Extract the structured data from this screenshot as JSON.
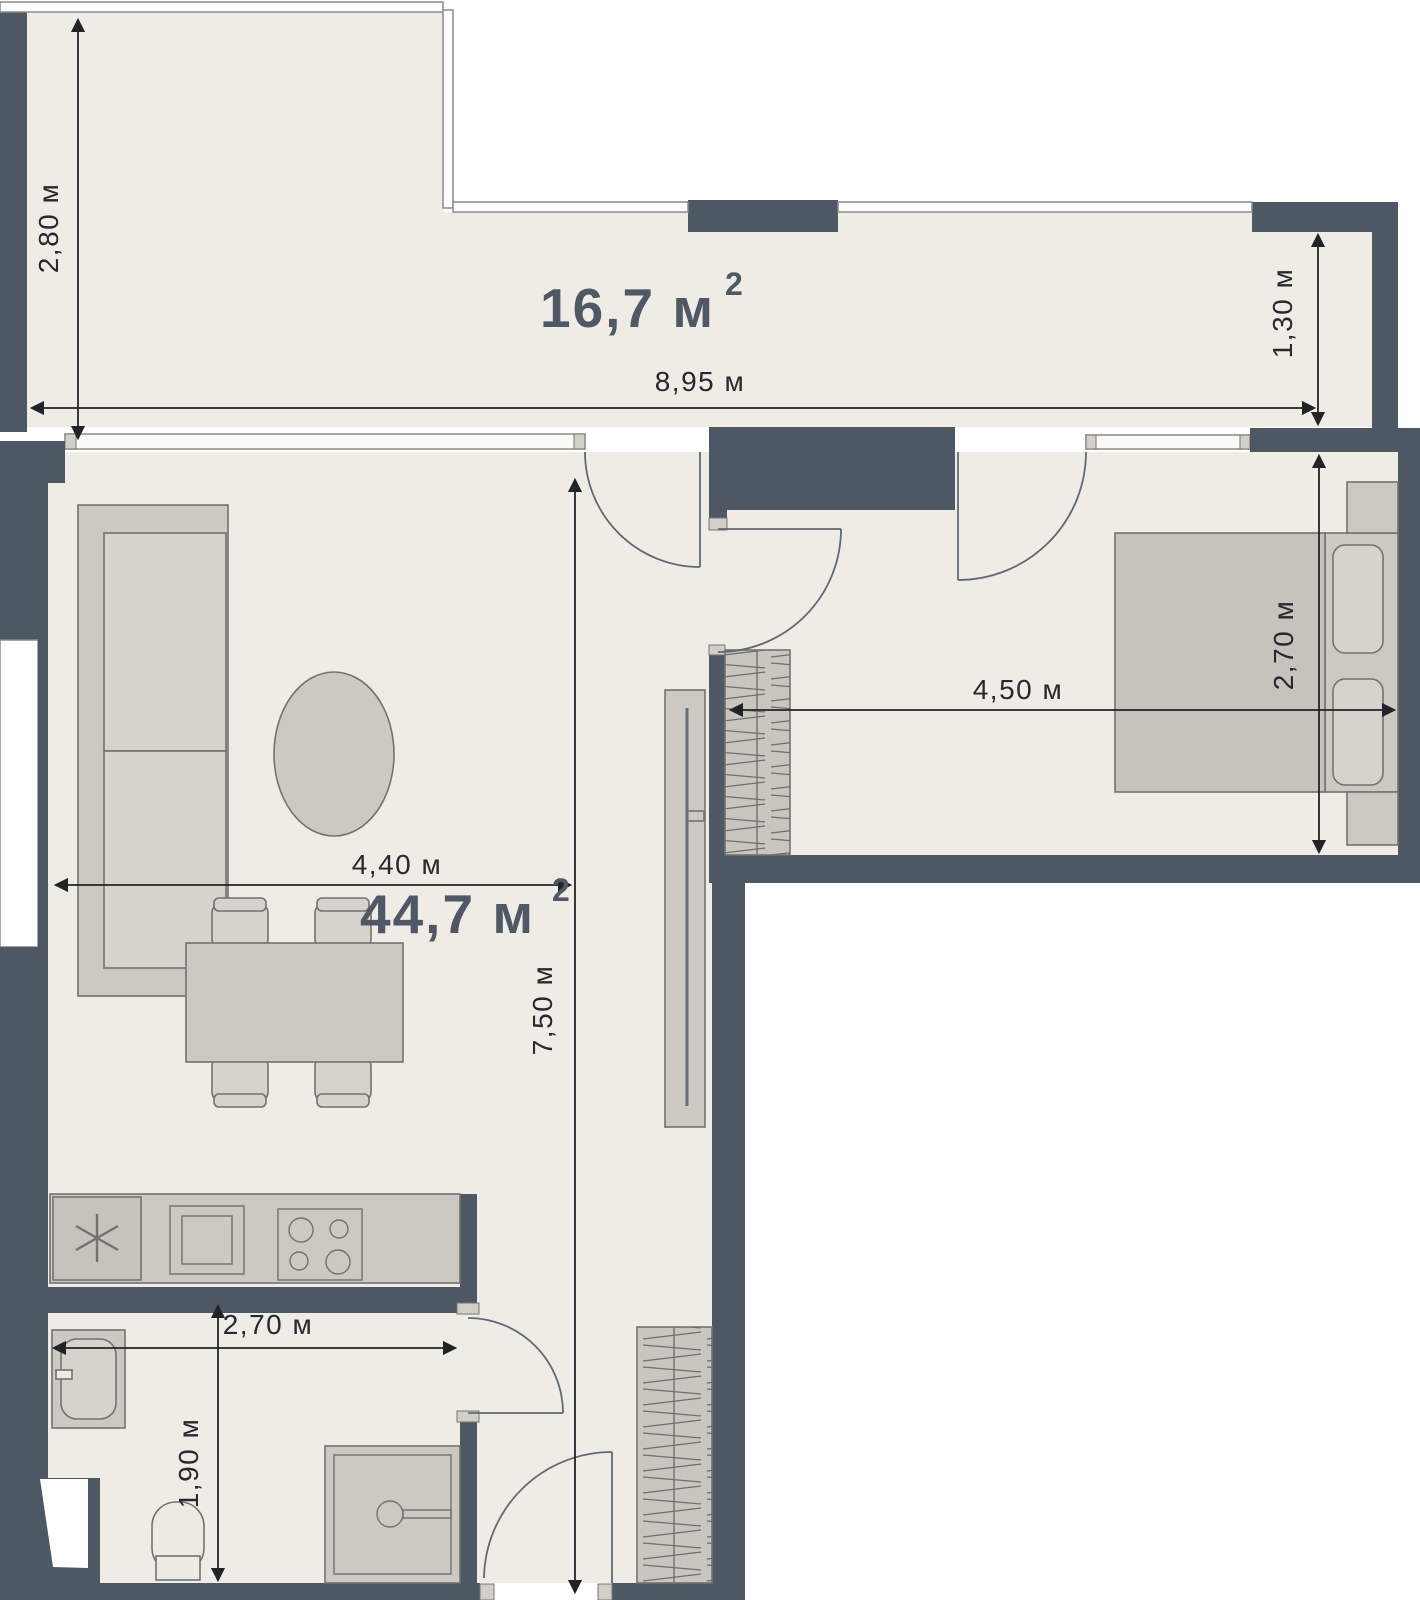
{
  "plan": {
    "type": "apartment-floor-plan",
    "rooms": [
      {
        "name": "terrace",
        "area": "16,7 м",
        "area_sup": "2"
      },
      {
        "name": "living-kitchen",
        "area": "44,7 м",
        "area_sup": "2"
      }
    ],
    "dimensions": {
      "terrace_height": "2,80 м",
      "terrace_width": "8,95 м",
      "terrace_right_depth": "1,30 м",
      "living_width": "4,40 м",
      "apartment_depth": "7,50 м",
      "bedroom_width": "4,50 м",
      "bedroom_depth": "2,70 м",
      "kitchen_width": "2,70 м",
      "bathroom_depth": "1,90 м"
    },
    "colors": {
      "wall": "#4D5864",
      "floor": "#EFECE6",
      "furniture": "#CCC8C2",
      "furniture_light": "#D6D2CC",
      "outline": "#72726E",
      "dimension_line": "#212426",
      "area_label": "#4E5965",
      "background": "#FFFFFF"
    }
  }
}
